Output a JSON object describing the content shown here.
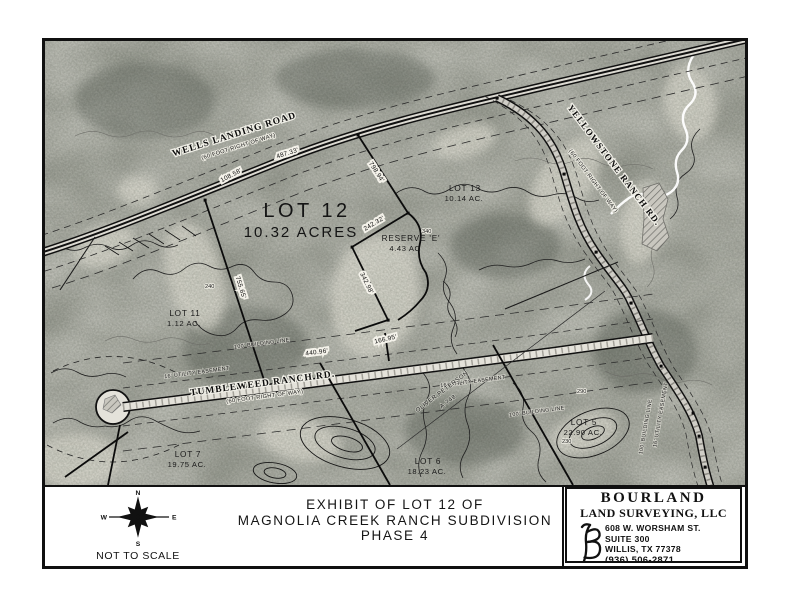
{
  "map": {
    "roads": {
      "wells_name": "WELLS LANDING ROAD",
      "wells_row": "(60 FOOT RIGHT OF WAY)",
      "yellowstone_name": "YELLOWSTONE RANCH RD.",
      "yellowstone_row": "(60 FOOT RIGHT OF WAY)",
      "tumbleweed_name": "TUMBLEWEED RANCH RD.",
      "tumbleweed_row": "(60 FOOT RIGHT OF WAY)"
    },
    "lots": {
      "lot12_name": "LOT 12",
      "lot12_area": "10.32 ACRES",
      "lot13_name": "LOT 13",
      "lot13_area": "10.14 AC.",
      "lot11_name": "LOT 11",
      "lot11_area": "1.12 AC.",
      "lot7_name": "LOT 7",
      "lot7_area": "19.75 AC.",
      "lot6_name": "LOT 6",
      "lot6_area": "18.23 AC.",
      "lot5_name": "LOT 5",
      "lot5_area": "22.90 AC.",
      "reserve_name": "RESERVE 'E'",
      "reserve_area": "4.43 AC"
    },
    "dimensions": {
      "wells_487": "487.33'",
      "wells_108": "108.58'",
      "east_798": "798.94'",
      "reserve_242": "242.32'",
      "reserve_342": "342.98'",
      "reserve_166": "166.95'",
      "west_755": "755.65'",
      "tumbleweed_440": "440.96'"
    },
    "easements": {
      "building": "100' BUILDING LINE",
      "utility": "16' UTILITY EASEMENT"
    },
    "abstract": {
      "owner": "OLIVER PETERSON",
      "number": "A-748"
    },
    "contours": {
      "c340": "340",
      "c240": "240",
      "c230": "230",
      "c290": "290"
    }
  },
  "title_block": {
    "title_line1": "EXHIBIT OF LOT 12 OF",
    "title_line2": "MAGNOLIA CREEK RANCH SUBDIVISION",
    "title_line3": "PHASE 4",
    "scale_note": "NOT TO SCALE",
    "compass": {
      "n": "N",
      "s": "S",
      "e": "E",
      "w": "W"
    }
  },
  "firm": {
    "name_line1": "BOURLAND",
    "name_line2": "LAND SURVEYING, LLC",
    "address1": "608 W. WORSHAM ST.",
    "address2": "SUITE 300",
    "address3": "WILLIS, TX 77378",
    "phone": "(936) 506-2871",
    "reg": "TBPLS FIRM REG # 10194525"
  }
}
